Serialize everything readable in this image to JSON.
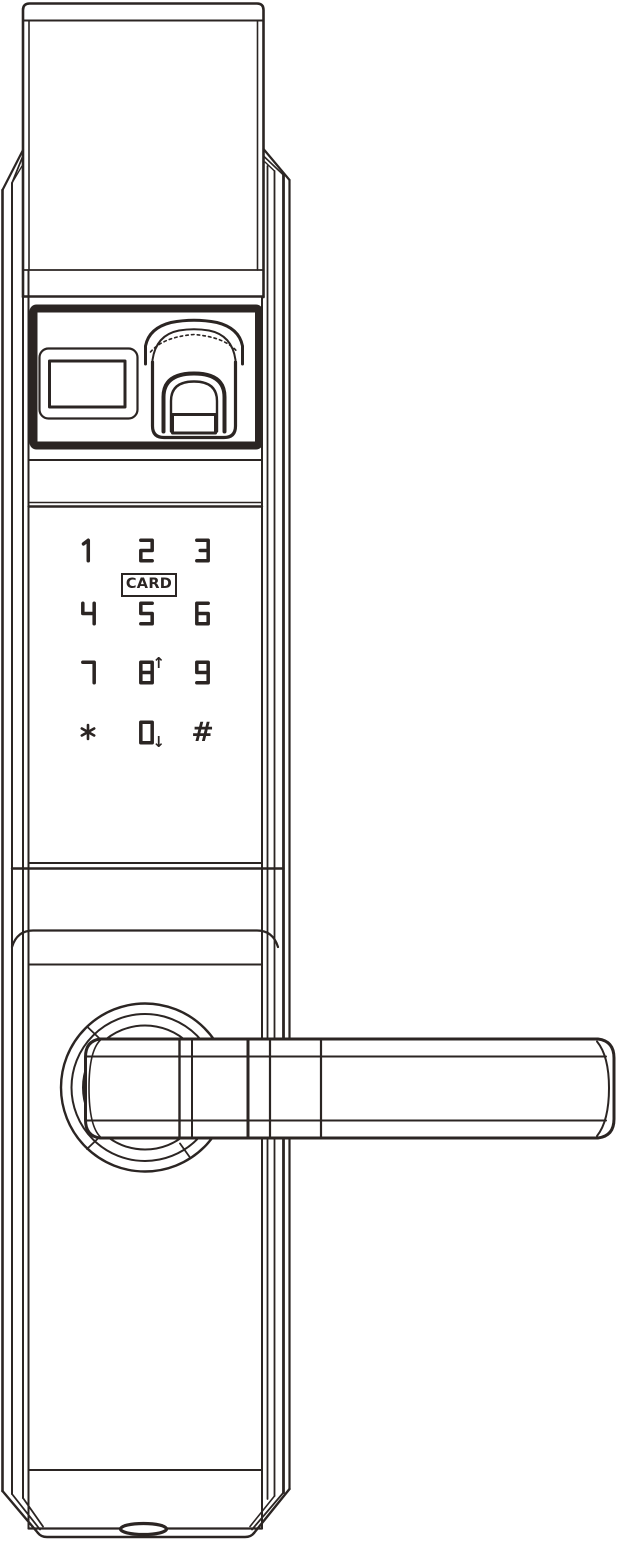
{
  "keypad": {
    "card_label": "CARD",
    "keys": [
      {
        "label": "1"
      },
      {
        "label": "2"
      },
      {
        "label": "3"
      },
      {
        "label": "4"
      },
      {
        "label": "5"
      },
      {
        "label": "6"
      },
      {
        "label": "7"
      },
      {
        "label": "8",
        "arrow": "up",
        "arrow_glyph": "↑"
      },
      {
        "label": "9"
      },
      {
        "label": "*"
      },
      {
        "label": "0",
        "arrow": "down",
        "arrow_glyph": "↓"
      },
      {
        "label": "#"
      }
    ]
  },
  "colors": {
    "line": "#2b2523",
    "background": "#ffffff"
  }
}
